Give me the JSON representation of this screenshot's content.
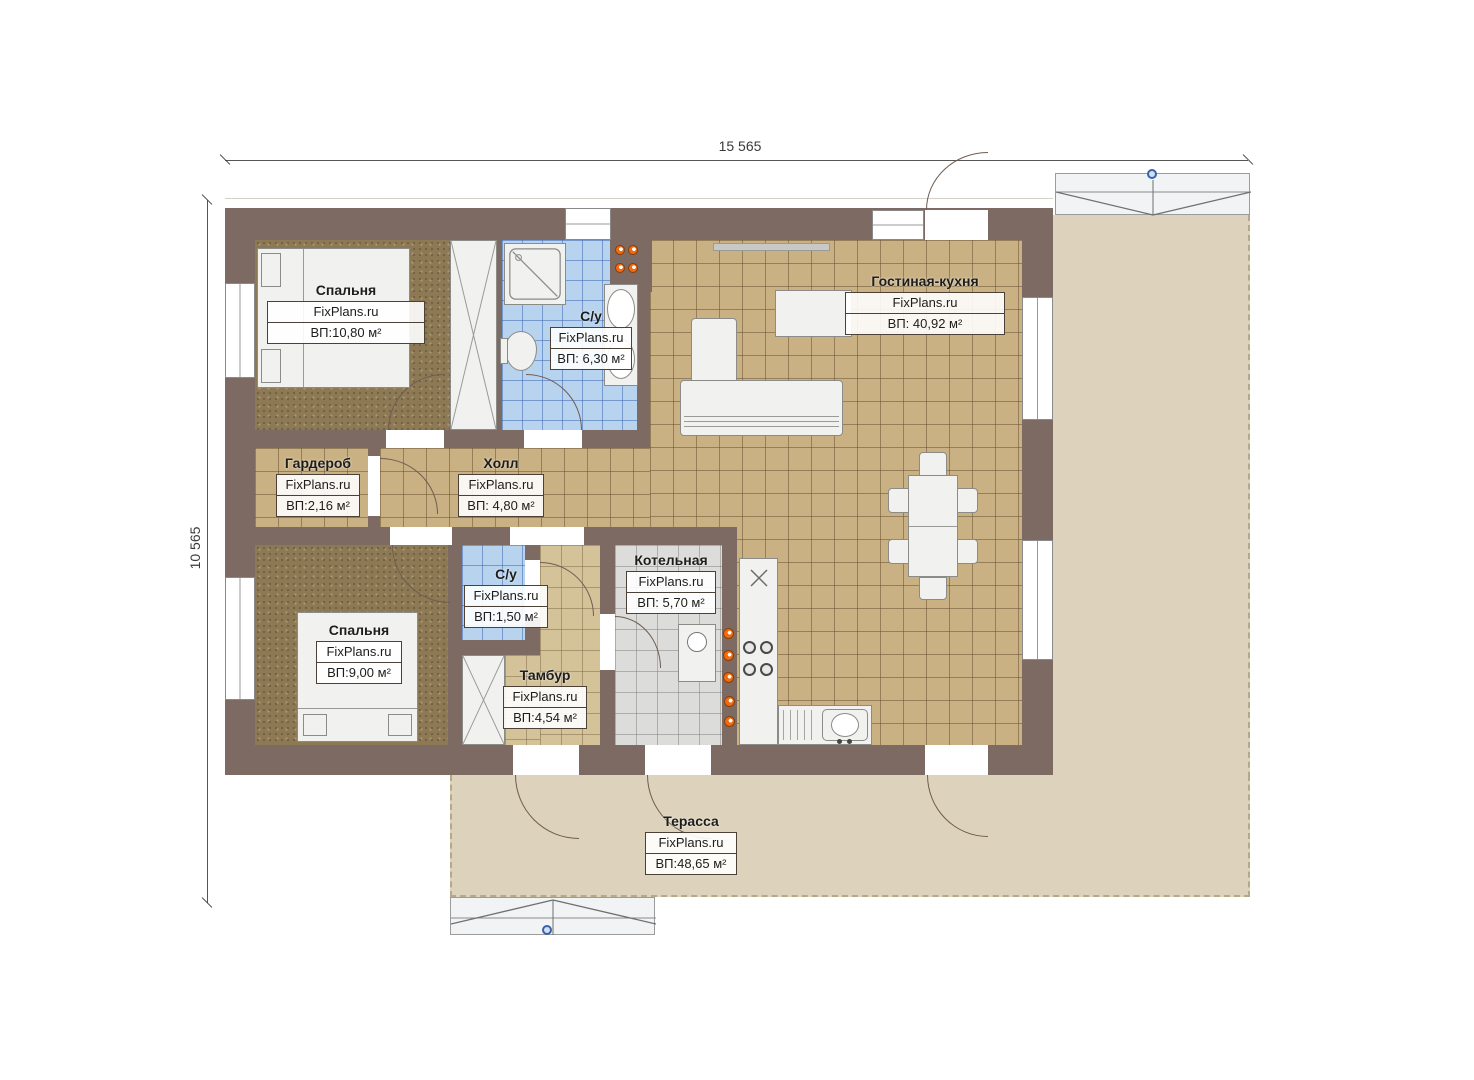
{
  "title": "floor-plan",
  "dimensions": {
    "width_label": "15 565",
    "height_label": "10 565"
  },
  "rooms": {
    "bedroom1": {
      "name": "Спальня",
      "brand": "FixPlans.ru",
      "area": "ВП:10,80 м²"
    },
    "bathroom1": {
      "name": "С/у",
      "brand": "FixPlans.ru",
      "area": "ВП: 6,30 м²"
    },
    "living": {
      "name": "Гостиная-кухня",
      "brand": "FixPlans.ru",
      "area": "ВП: 40,92 м²"
    },
    "wardrobe": {
      "name": "Гардероб",
      "brand": "FixPlans.ru",
      "area": "ВП:2,16 м²"
    },
    "hall": {
      "name": "Холл",
      "brand": "FixPlans.ru",
      "area": "ВП: 4,80 м²"
    },
    "bedroom2": {
      "name": "Спальня",
      "brand": "FixPlans.ru",
      "area": "ВП:9,00 м²"
    },
    "bathroom2": {
      "name": "С/у",
      "brand": "FixPlans.ru",
      "area": "ВП:1,50 м²"
    },
    "boiler": {
      "name": "Котельная",
      "brand": "FixPlans.ru",
      "area": "ВП: 5,70 м²"
    },
    "vestibule": {
      "name": "Тамбур",
      "brand": "FixPlans.ru",
      "area": "ВП:4,54 м²"
    },
    "terrace": {
      "name": "Терасса",
      "brand": "FixPlans.ru",
      "area": "ВП:48,65 м²"
    }
  },
  "colors": {
    "wall": "#7d6b63",
    "floor_tile_tan": "#c9b183",
    "floor_tile_blue": "#b7d3ee",
    "floor_tile_gray": "#dcdcda",
    "floor_bedroom": "#8d7a55",
    "terrace": "#ddd2bb",
    "burner_accent": "#ef6a10",
    "marker_blue": "#3a62a8"
  }
}
